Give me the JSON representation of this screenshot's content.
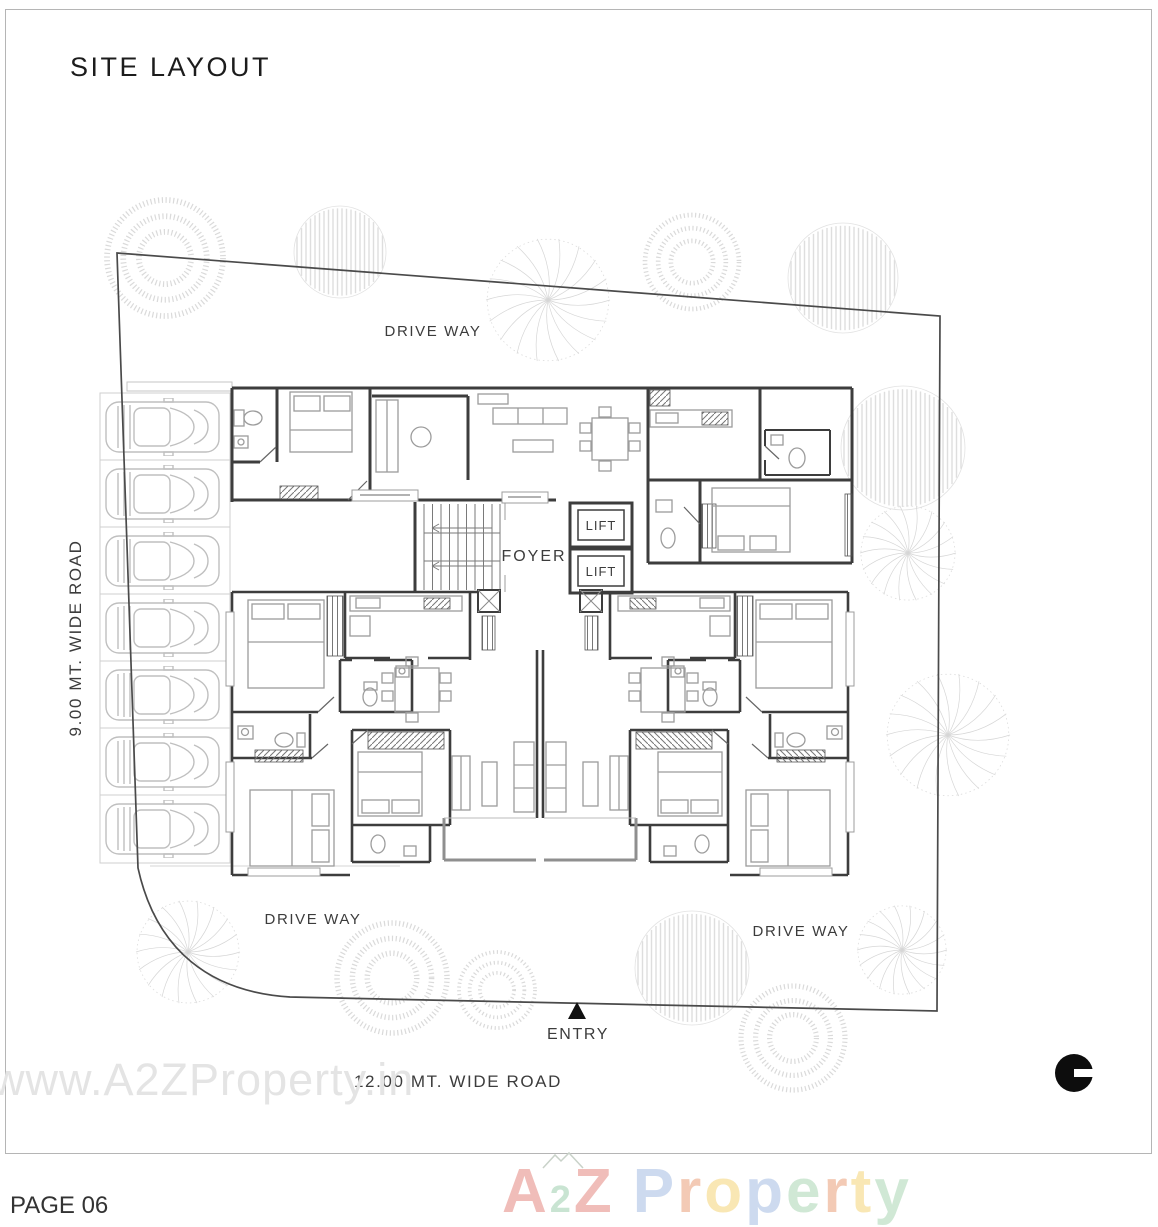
{
  "sheet": {
    "title": "SITE LAYOUT",
    "page_number": "PAGE 06",
    "watermark": "www.A2ZProperty.in"
  },
  "plan_labels": {
    "driveway_top": "DRIVE WAY",
    "driveway_bottom_left": "DRIVE WAY",
    "driveway_bottom_right": "DRIVE WAY",
    "foyer": "FOYER",
    "lift_upper": "LIFT",
    "lift_lower": "LIFT",
    "entry": "ENTRY",
    "road_left": "9.00 MT. WIDE ROAD",
    "road_bottom": "12.00 MT. WIDE ROAD"
  },
  "branding": {
    "logo_letters": [
      {
        "ch": "A",
        "color": "#d9534a",
        "small": false
      },
      {
        "ch": "2",
        "color": "#74b98c",
        "small": true
      },
      {
        "ch": "Z",
        "color": "#d9534a",
        "small": false
      },
      {
        "ch": " ",
        "color": "#000000",
        "small": false
      },
      {
        "ch": "P",
        "color": "#7d9fd6",
        "small": false
      },
      {
        "ch": "r",
        "color": "#e2763f",
        "small": false
      },
      {
        "ch": "o",
        "color": "#f0c23c",
        "small": false
      },
      {
        "ch": "p",
        "color": "#7d9fd6",
        "small": false
      },
      {
        "ch": "e",
        "color": "#86c493",
        "small": false
      },
      {
        "ch": "r",
        "color": "#e2763f",
        "small": false
      },
      {
        "ch": "t",
        "color": "#f0c23c",
        "small": false
      },
      {
        "ch": "y",
        "color": "#86c493",
        "small": false
      }
    ]
  },
  "icons": {
    "north_indicator": "filled-circle-with-notch",
    "entry_marker": "triangle-up"
  },
  "colors": {
    "walls": "#3d3d3d",
    "furniture": "#9c9c9c",
    "boundary": "#4a4a4a",
    "trees": "#d8d8d8",
    "parking": "#c9c9c9",
    "balcony": "#8f8f8f",
    "watermark": "#e4e4e4",
    "sheet_border": "#b5b5b5"
  }
}
